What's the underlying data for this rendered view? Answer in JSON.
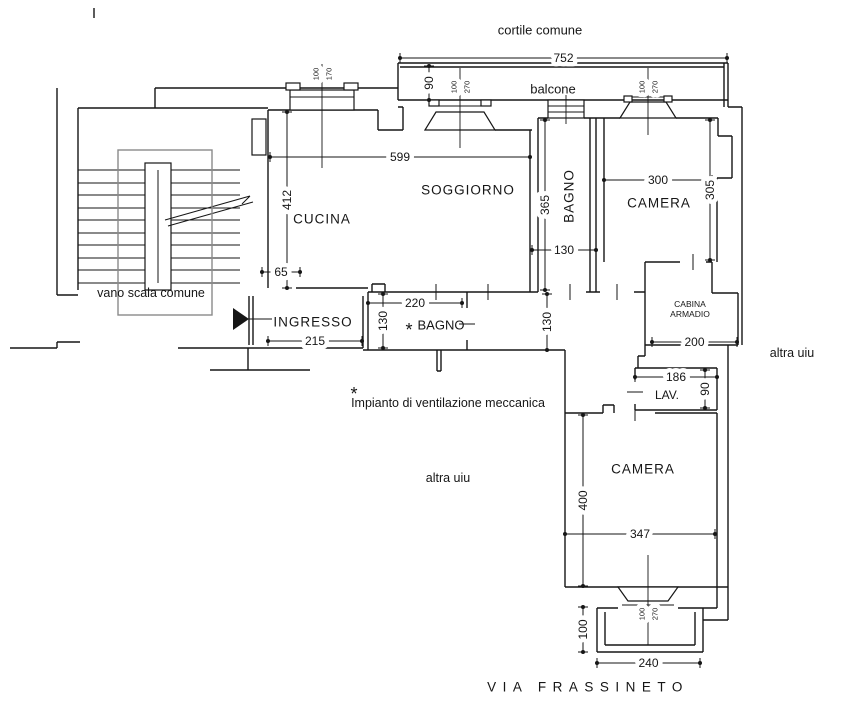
{
  "meta": {
    "drawing_type": "apartment floor plan",
    "ink_color": "#161616",
    "stair_box_color": "#8a8a8a",
    "background": "#ffffff"
  },
  "plan": {
    "room_labels": [
      {
        "name": "label-cortile-comune",
        "text": "cortile comune",
        "x": 540,
        "y": 30,
        "size": 13
      },
      {
        "name": "label-balcone",
        "text": "balcone",
        "x": 553,
        "y": 89,
        "size": 13
      },
      {
        "name": "label-soggiorno",
        "text": "SOGGIORNO",
        "x": 468,
        "y": 190,
        "size": 13.5,
        "ls": 1
      },
      {
        "name": "label-cucina",
        "text": "CUCINA",
        "x": 322,
        "y": 219,
        "size": 13.5,
        "ls": 1
      },
      {
        "name": "label-bagno-top",
        "text": "BAGNO",
        "x": 569,
        "y": 196,
        "size": 13.5,
        "ls": 1,
        "rot": -90
      },
      {
        "name": "label-camera-top",
        "text": "CAMERA",
        "x": 659,
        "y": 203,
        "size": 13.5,
        "ls": 1
      },
      {
        "name": "label-cabina-armadio-1",
        "text": "CABINA",
        "x": 690,
        "y": 304,
        "size": 8.5
      },
      {
        "name": "label-cabina-armadio-2",
        "text": "ARMADIO",
        "x": 690,
        "y": 314,
        "size": 8.5
      },
      {
        "name": "label-ingresso",
        "text": "INGRESSO",
        "x": 313,
        "y": 322,
        "size": 13.5,
        "ls": 1
      },
      {
        "name": "label-bagno-star-asterisk",
        "text": "*",
        "x": 409,
        "y": 330,
        "size": 18
      },
      {
        "name": "label-bagno-star",
        "text": "BAGNO",
        "x": 441,
        "y": 325,
        "size": 13
      },
      {
        "name": "label-lav",
        "text": "LAV.",
        "x": 667,
        "y": 395,
        "size": 12
      },
      {
        "name": "label-camera-bottom",
        "text": "CAMERA",
        "x": 643,
        "y": 469,
        "size": 13.5,
        "ls": 1
      },
      {
        "name": "label-vano-scala-comune",
        "text": "vano scala comune",
        "x": 151,
        "y": 293,
        "size": 12.5
      },
      {
        "name": "label-altra-uiu-right",
        "text": "altra uiu",
        "x": 792,
        "y": 353,
        "size": 12.5
      },
      {
        "name": "label-altra-uiu-bottom",
        "text": "altra uiu",
        "x": 448,
        "y": 478,
        "size": 12.5
      },
      {
        "name": "label-note-asterisk",
        "text": "*",
        "x": 354,
        "y": 394,
        "size": 18
      },
      {
        "name": "label-note-ventilazione",
        "text": "Impianto di ventilazione meccanica",
        "x": 448,
        "y": 403,
        "size": 12.5
      },
      {
        "name": "label-via-frassineto",
        "text": "VIA FRASSINETO",
        "x": 588,
        "y": 687,
        "size": 13.5,
        "ls": 6.5
      }
    ],
    "dimensions": [
      {
        "name": "dim-752-balcone",
        "text": "752",
        "x1": 400,
        "y1": 58,
        "x2": 727,
        "y2": 58
      },
      {
        "name": "dim-90-balcone",
        "text": "90",
        "x1": 429,
        "y1": 66,
        "x2": 429,
        "y2": 100
      },
      {
        "name": "dim-599-soggiorno",
        "text": "599",
        "x1": 270,
        "y1": 157,
        "x2": 530,
        "y2": 157
      },
      {
        "name": "dim-412-cucina",
        "text": "412",
        "x1": 287,
        "y1": 112,
        "x2": 287,
        "y2": 288
      },
      {
        "name": "dim-365-bagno",
        "text": "365",
        "x1": 545,
        "y1": 120,
        "x2": 545,
        "y2": 290
      },
      {
        "name": "dim-130-bagno-larghezza",
        "text": "130",
        "x1": 532,
        "y1": 250,
        "x2": 596,
        "y2": 250
      },
      {
        "name": "dim-300-camera",
        "text": "300",
        "x1": 604,
        "y1": 180,
        "x2": 712,
        "y2": 180
      },
      {
        "name": "dim-305-camera",
        "text": "305",
        "x1": 710,
        "y1": 120,
        "x2": 710,
        "y2": 260
      },
      {
        "name": "dim-65-passaggio",
        "text": "65",
        "x1": 262,
        "y1": 272,
        "x2": 300,
        "y2": 272
      },
      {
        "name": "dim-215-ingresso",
        "text": "215",
        "x1": 268,
        "y1": 341,
        "x2": 362,
        "y2": 341
      },
      {
        "name": "dim-220-bagno2",
        "text": "220",
        "x1": 368,
        "y1": 303,
        "x2": 462,
        "y2": 303
      },
      {
        "name": "dim-130-bagno2-altezza",
        "text": "130",
        "x1": 383,
        "y1": 294,
        "x2": 383,
        "y2": 348
      },
      {
        "name": "dim-130-corridoio",
        "text": "130",
        "x1": 547,
        "y1": 294,
        "x2": 547,
        "y2": 350
      },
      {
        "name": "dim-200-cabina",
        "text": "200",
        "x1": 652,
        "y1": 342,
        "x2": 737,
        "y2": 342
      },
      {
        "name": "dim-186-lav",
        "text": "186",
        "x1": 635,
        "y1": 377,
        "x2": 717,
        "y2": 377
      },
      {
        "name": "dim-90-lav",
        "text": "90",
        "x1": 705,
        "y1": 370,
        "x2": 705,
        "y2": 408
      },
      {
        "name": "dim-400-camera2",
        "text": "400",
        "x1": 583,
        "y1": 415,
        "x2": 583,
        "y2": 586
      },
      {
        "name": "dim-347-camera2",
        "text": "347",
        "x1": 565,
        "y1": 534,
        "x2": 715,
        "y2": 534
      },
      {
        "name": "dim-100-balconcino",
        "text": "100",
        "x1": 583,
        "y1": 607,
        "x2": 583,
        "y2": 652
      },
      {
        "name": "dim-240-balconcino",
        "text": "240",
        "x1": 597,
        "y1": 663,
        "x2": 700,
        "y2": 663
      }
    ],
    "window_tags": [
      {
        "name": "window-tag-cucina",
        "w": "100",
        "h": "170",
        "x": 322,
        "y": 74
      },
      {
        "name": "window-tag-soggiorno",
        "w": "100",
        "h": "270",
        "x": 460,
        "y": 87
      },
      {
        "name": "window-tag-camera-top",
        "w": "100",
        "h": "270",
        "x": 648,
        "y": 87
      },
      {
        "name": "window-tag-camera-bottom",
        "w": "100",
        "h": "270",
        "x": 648,
        "y": 614
      }
    ]
  }
}
